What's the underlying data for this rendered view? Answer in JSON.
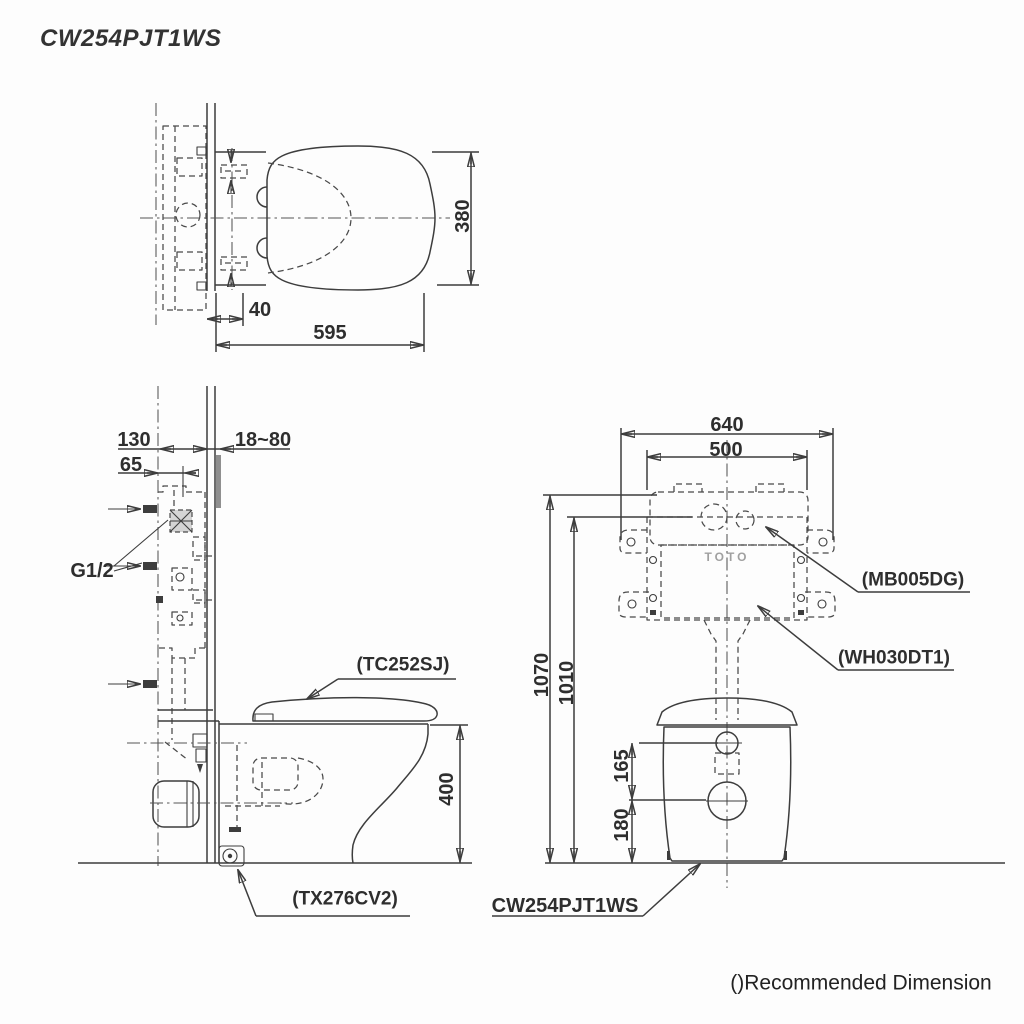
{
  "title": "CW254PJT1WS",
  "note": "()Recommended Dimension",
  "logo": "TOTO",
  "top_view": {
    "dim_depth": "380",
    "dim_offset": "40",
    "dim_width": "595"
  },
  "side_view": {
    "dim_frame_depth": "130",
    "dim_inlet_offset": "65",
    "dim_wall": "18~80",
    "dim_height": "400",
    "label_inlet": "G1/2",
    "label_seat": "(TC252SJ)",
    "label_fitting": "(TX276CV2)"
  },
  "front_view": {
    "dim_frame_width": "640",
    "dim_tank_width": "500",
    "dim_h1": "1070",
    "dim_h2": "1010",
    "dim_hole_upper": "165",
    "dim_hole_lower": "180",
    "label_plate": "(MB005DG)",
    "label_tank": "(WH030DT1)",
    "label_bowl": "CW254PJT1WS"
  }
}
